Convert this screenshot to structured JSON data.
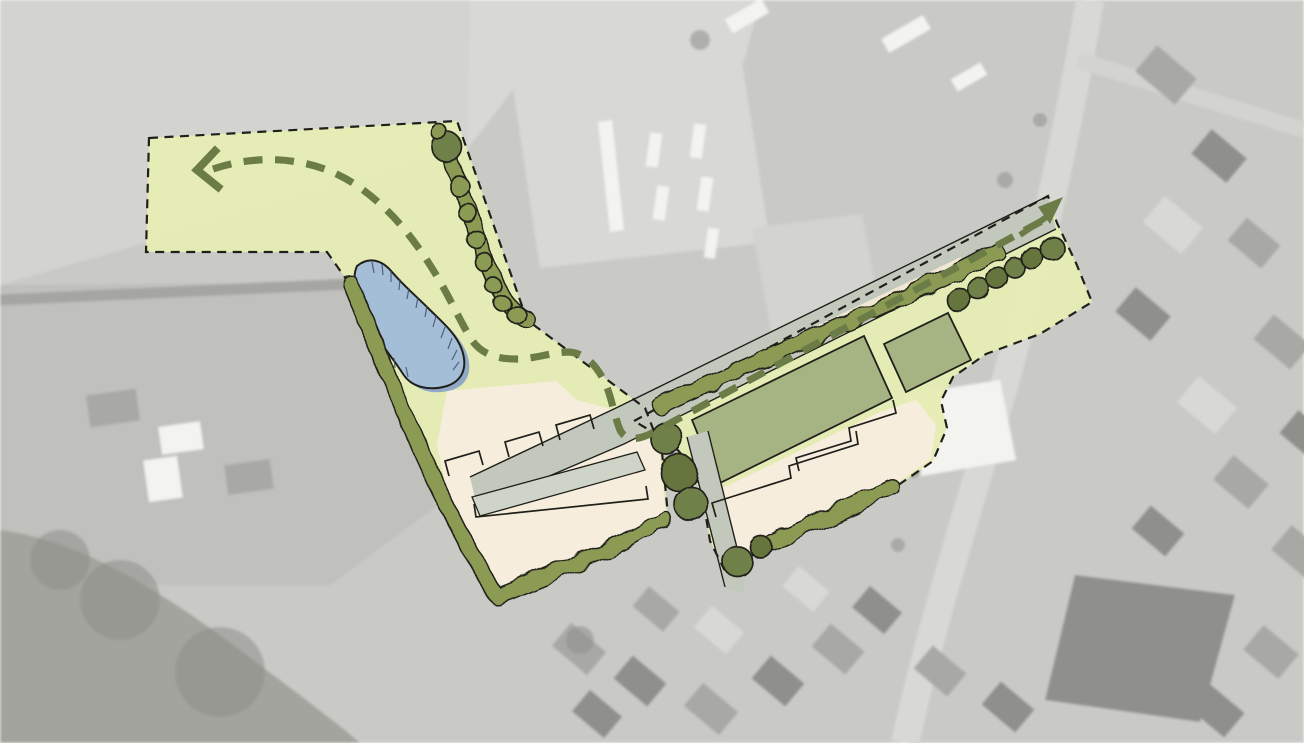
{
  "scene": {
    "kind": "landscape-masterplan-sketch-over-aerial-photo",
    "orientation": "plan runs diagonally from lower-left village edge to upper-right street"
  },
  "palette": {
    "plan_green": "#e6ecb4",
    "hedge_green": "#8c9b52",
    "tree_green": "#70804a",
    "tree_dark": "#65743d",
    "route_green": "#6c7c46",
    "field_green": "#a6b483",
    "plot_beige": "#f6eddc",
    "road_grey": "#c3c8bc",
    "driveway_grey": "#cfd4c8",
    "path_cream": "#f1e8d3",
    "pond_blue": "#a5bed8",
    "pond_shadow": "#8fa9c7",
    "pond_hatch": "#3a4a63",
    "ink": "#20201b",
    "photo_base": "#c9cac6",
    "photo_field": "#d3d3cf",
    "photo_field_mid": "#c0c0bc",
    "photo_light": "#d8d8d4",
    "photo_white": "#f3f3f0",
    "photo_mid": "#a8a8a4",
    "photo_dark": "#8f8f8b",
    "photo_tree": "#a4a49f"
  },
  "features": {
    "site_boundary": {
      "style": "black dashed line",
      "areas": 2
    },
    "walking_route": {
      "style": "green dashed line",
      "arrow_west": "arrowhead pointing west in top-left meadow",
      "arrow_northeast": "solid arrowhead pointing northeast at street"
    },
    "pond": {
      "count": 1,
      "style": "blue blob with hand-drawn hatching"
    },
    "paddocks": {
      "count": 2,
      "style": "sage green outlined rectangles"
    },
    "building_plots": {
      "count": 2,
      "style": "beige with sketched footprint lines"
    },
    "roads": {
      "main_lane": 1,
      "south_branch": 1,
      "inner_driveway": 1
    },
    "trees": {
      "northeast_row": 6,
      "junction_cluster": 3,
      "south_branch_pair": 2,
      "northwest_hedge_chain": 9
    },
    "hedgerows": {
      "count": 5
    }
  }
}
